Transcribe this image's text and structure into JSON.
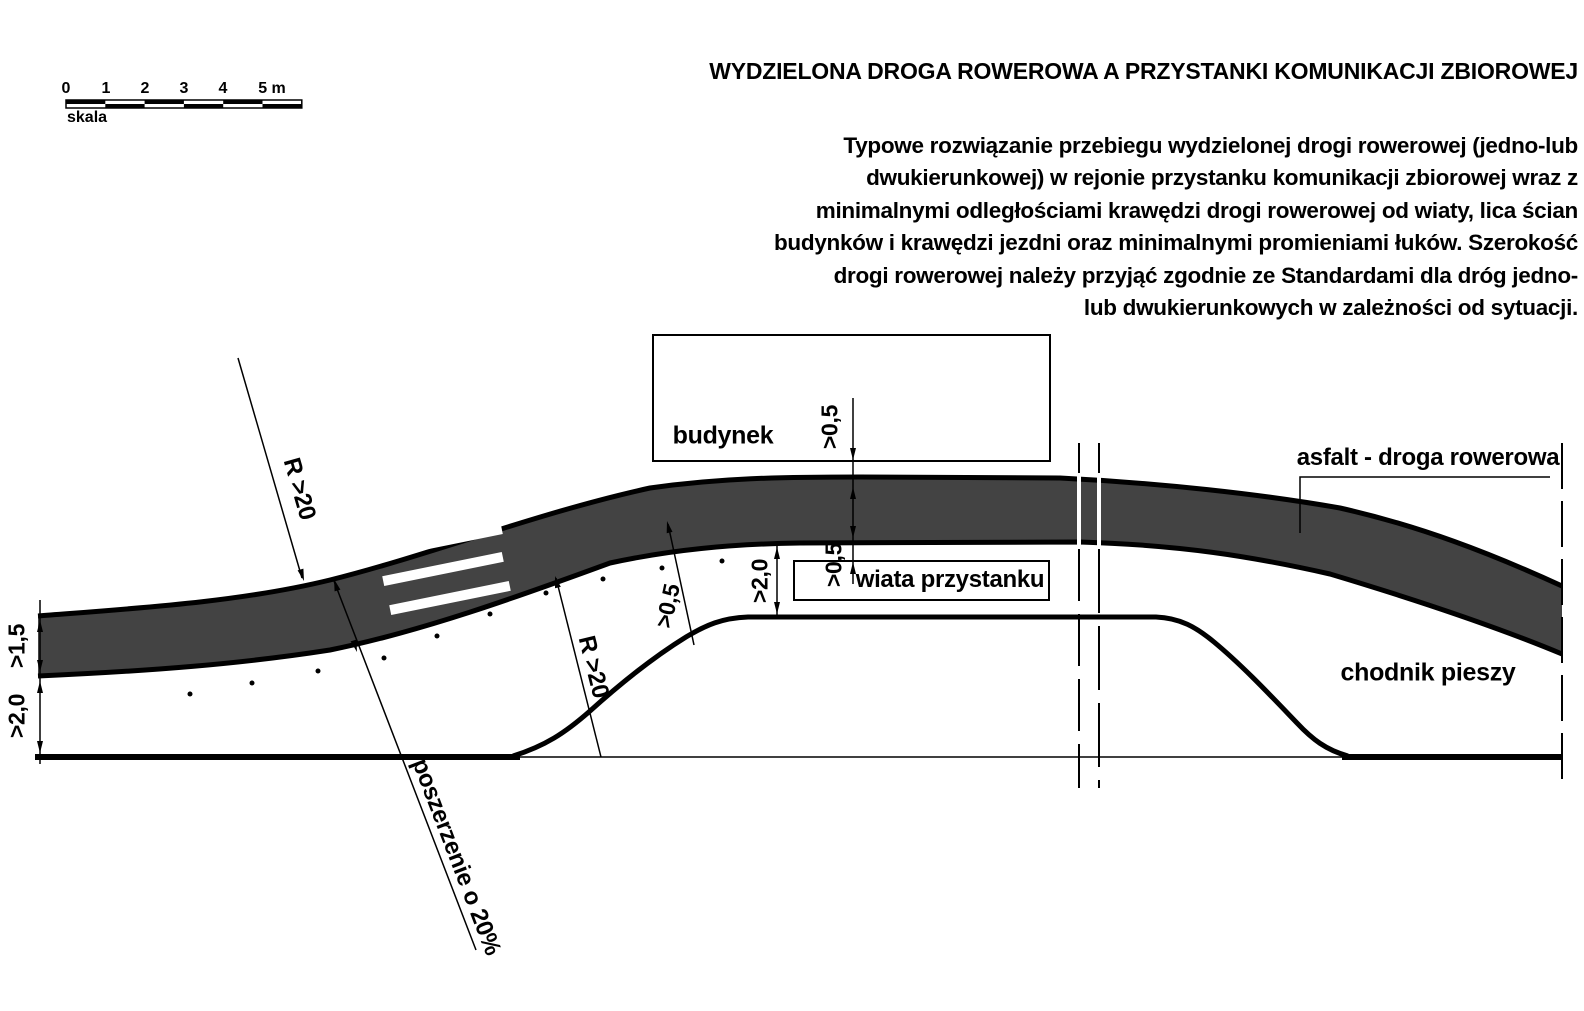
{
  "title": "WYDZIELONA DROGA ROWEROWA A PRZYSTANKI KOMUNIKACJI ZBIOROWEJ",
  "description": "Typowe rozwiązanie przebiegu wydzielonej drogi rowerowej (jedno-lub\ndwukierunkowej) w rejonie przystanku komunikacji zbiorowej wraz z\nminimalnymi odległościami krawędzi drogi rowerowej od wiaty, lica ścian\nbudynków i krawędzi jezdni oraz minimalnymi promieniami łuków. Szerokość\ndrogi rowerowej należy przyjąć zgodnie ze Standardami dla dróg jedno-\nlub dwukierunkowych w zależności od sytuacji.",
  "scalebar": {
    "labels": [
      "0",
      "1",
      "2",
      "3",
      "4",
      "5 m"
    ],
    "caption": "skala"
  },
  "diagram": {
    "bike_path_label": "asfalt - droga rowerowa",
    "sidewalk_label": "chodnik pieszy",
    "building_label": "budynek",
    "shelter_label": "wiata przystanku",
    "widening_label": "poszerzenie o 20%",
    "radius_label_1": "R >20",
    "radius_label_2": "R >20",
    "dim_path_width": ">1,5",
    "dim_sidewalk_width": ">2,0",
    "dim_platform_width": ">2,0",
    "dim_building_offset": ">0,5",
    "dim_shelter_offset": ">0,5",
    "dim_edge_offset": ">0,5",
    "colors": {
      "asphalt": "#434343",
      "line": "#000000",
      "background": "#ffffff"
    }
  }
}
